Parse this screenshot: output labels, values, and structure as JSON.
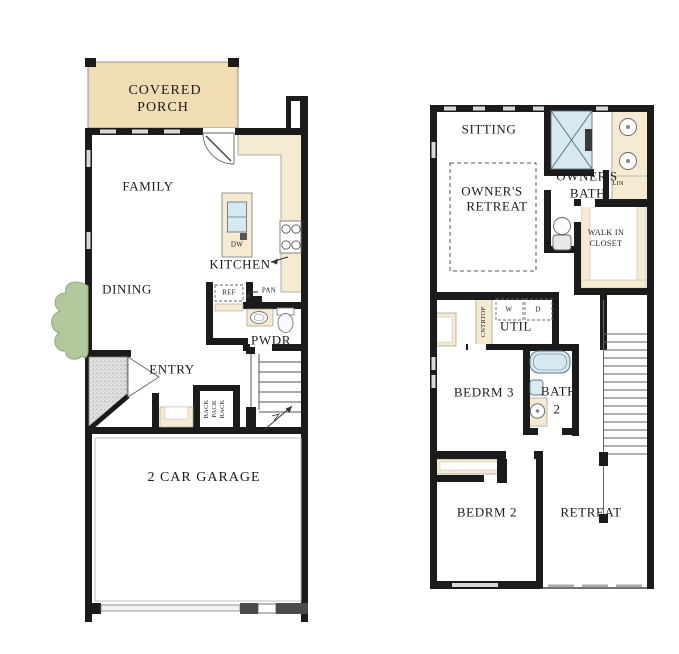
{
  "plan_type": "two-story floor plan",
  "colors": {
    "wall": "#1b1b1b",
    "porch_tan": "#f0ddb3",
    "counter_tan": "#f6ead0",
    "fixture_blue": "#d7e9f0",
    "tree_green": "#b1c89c",
    "stipple_gray": "#dcdcdc",
    "window_gray": "#d8d8d8"
  },
  "first_floor": {
    "covered_porch_line1": "COVERED",
    "covered_porch_line2": "PORCH",
    "family": "FAMILY",
    "kitchen": "KITCHEN",
    "dining": "DINING",
    "ref": "REF",
    "pan": "PAN",
    "dw": "DW",
    "pwdr": "PWDR",
    "entry": "ENTRY",
    "rack_words": [
      "BACK",
      "PACK",
      "RACK"
    ],
    "garage": "2 CAR GARAGE"
  },
  "second_floor": {
    "sitting": "SITTING",
    "owners_retreat_line1": "OWNER'S",
    "owners_retreat_line2": "RETREAT",
    "owners_bath_line1": "OWNER'S",
    "owners_bath_line2": "BATH",
    "lin": "LIN",
    "walk_in_closet_line1": "WALK IN",
    "walk_in_closet_line2": "CLOSET",
    "cntrtop": "CNTRTOP",
    "washer": "W",
    "dryer": "D",
    "util": "UTIL",
    "bedrm3": "BEDRM 3",
    "bath2_line1": "BATH",
    "bath2_line2": "2",
    "bedrm2": "BEDRM 2",
    "retreat": "RETREAT"
  }
}
